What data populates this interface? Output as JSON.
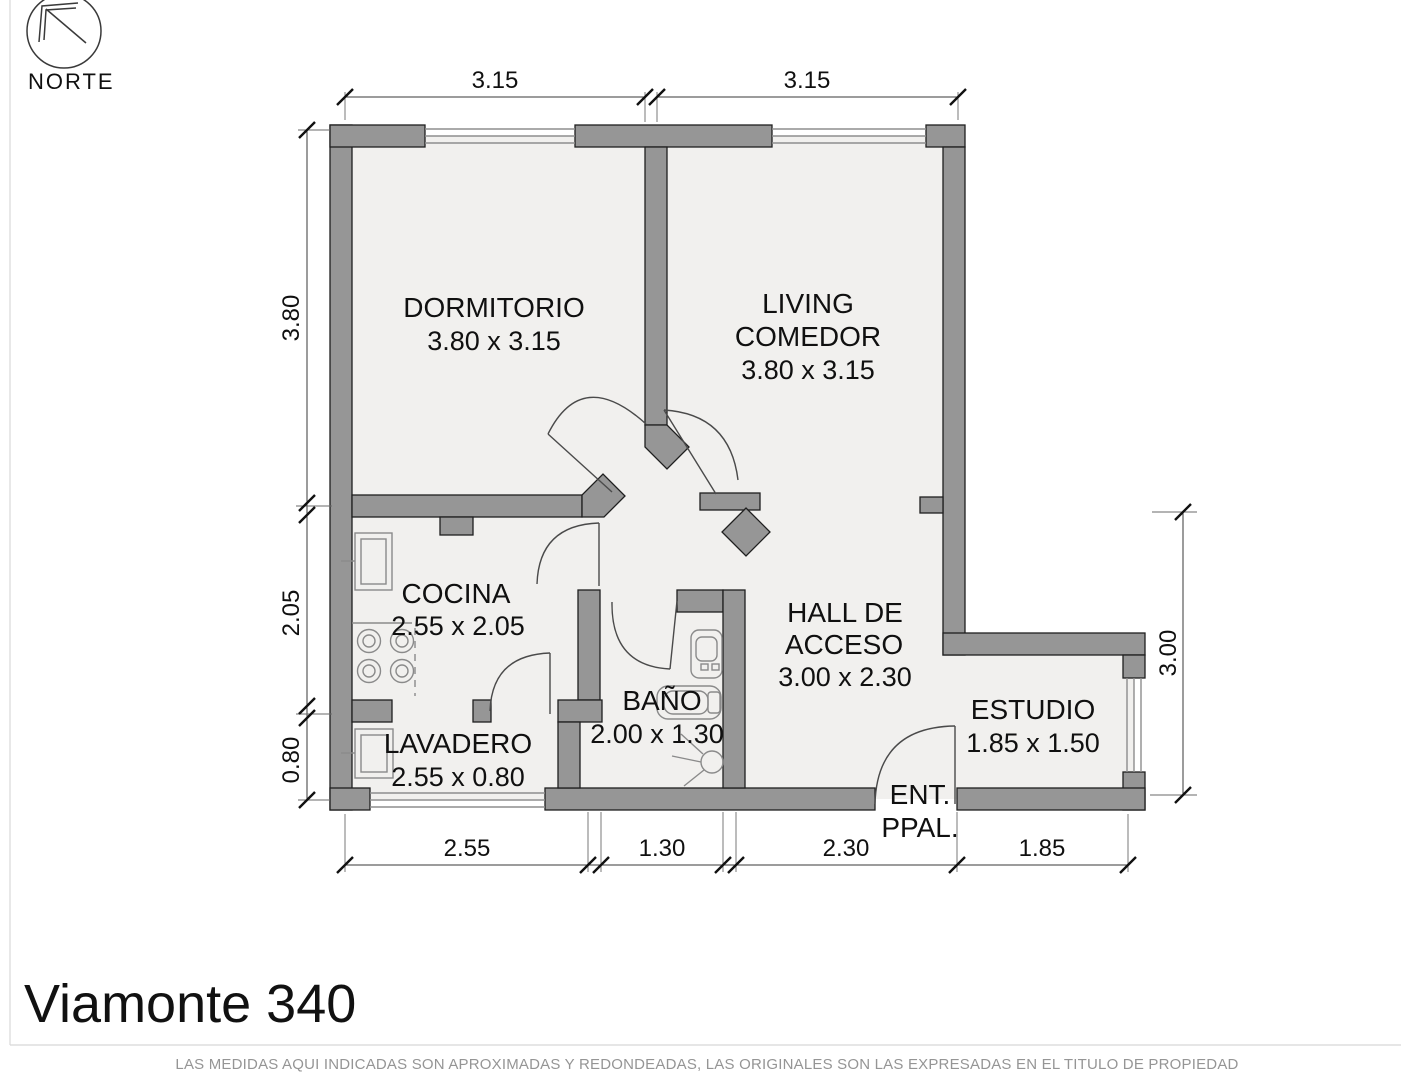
{
  "meta": {
    "title": "Viamonte 340",
    "footer": "LAS MEDIDAS AQUI INDICADAS SON APROXIMADAS Y REDONDEADAS, LAS ORIGINALES SON LAS EXPRESADAS EN EL TITULO DE PROPIEDAD",
    "north_label": "NORTE"
  },
  "rooms": {
    "dormitorio": {
      "name": "DORMITORIO",
      "size": "3.80 x 3.15"
    },
    "living": {
      "name_line1": "LIVING",
      "name_line2": "COMEDOR",
      "size": "3.80 x 3.15"
    },
    "cocina": {
      "name": "COCINA",
      "size": "2.55 x 2.05"
    },
    "bano": {
      "name": "BAÑO",
      "size": "2.00 x 1.30"
    },
    "hall": {
      "name_line1": "HALL DE",
      "name_line2": "ACCESO",
      "size": "3.00 x 2.30"
    },
    "lavadero": {
      "name": "LAVADERO",
      "size": "2.55 x 0.80"
    },
    "estudio": {
      "name": "ESTUDIO",
      "size": "1.85 x 1.50"
    },
    "entrada": {
      "name_line1": "ENT.",
      "name_line2": "PPAL."
    }
  },
  "dimensions": {
    "top": [
      "3.15",
      "3.15"
    ],
    "left": [
      "3.80",
      "2.05",
      "0.80"
    ],
    "right": [
      "3.00"
    ],
    "bottom": [
      "2.55",
      "1.30",
      "2.30",
      "1.85"
    ]
  },
  "colors": {
    "wall": "#969696",
    "floor": "#f1f0ee",
    "outline": "#1f1f1f"
  }
}
